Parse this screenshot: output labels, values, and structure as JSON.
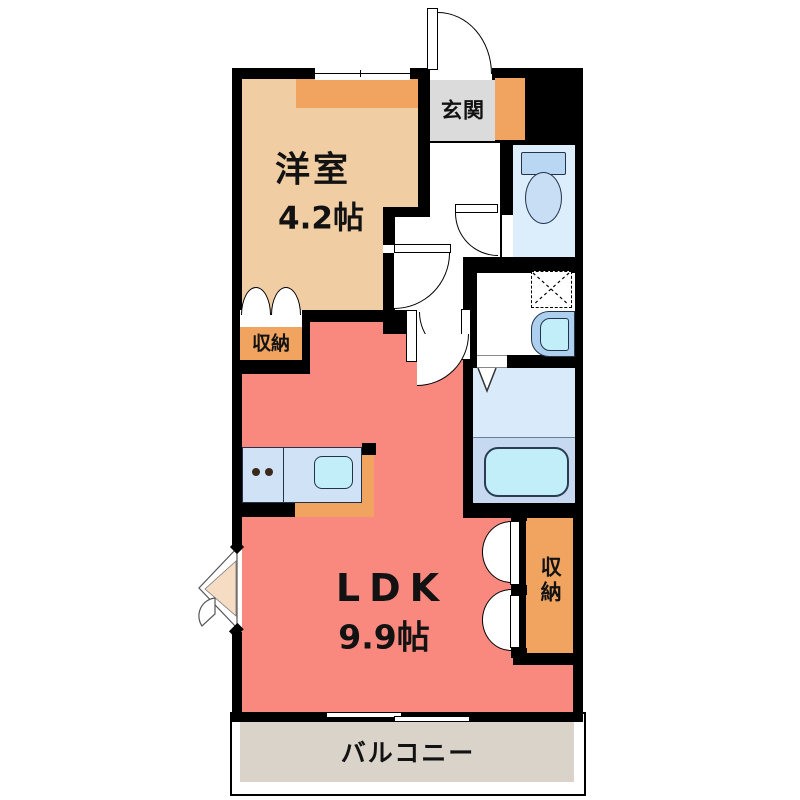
{
  "floorplan": {
    "type": "1LDK apartment floor plan",
    "rooms": {
      "entrance": {
        "label": "玄関"
      },
      "western": {
        "label": "洋室",
        "size": "4.2帖"
      },
      "ldk": {
        "label": "LDK",
        "size": "9.9帖"
      },
      "storage_west": {
        "label": "収納"
      },
      "storage_east": {
        "label": "収納"
      },
      "balcony": {
        "label": "バルコニー"
      }
    },
    "fixtures": [
      "entrance-door",
      "toilet",
      "washing-machine-space",
      "washbasin",
      "bathtub",
      "bifold-bath-door",
      "kitchen-counter",
      "stove-burners",
      "kitchen-sink",
      "closet-double-doors",
      "storage-double-doors",
      "bay-corner-door",
      "sliding-window-top",
      "sliding-window-balcony"
    ],
    "colors": {
      "wall": "#000000",
      "western_room_floor": "#f0cda3",
      "accent_orange": "#f0a45f",
      "ldk_floor": "#f9897f",
      "entrance_floor": "#dbdbdb",
      "balcony_floor": "#d9d3ca",
      "toilet_floor": "#dcedfb",
      "bath_floor_upper": "#d9eafb",
      "bath_floor_lower": "#c6d9f1",
      "fixture_blue": "#b9d7f2",
      "water_cyan": "#c2eef9",
      "kitchen_counter": "#cfe2f6",
      "bay_door": "#f5dcc2"
    }
  }
}
